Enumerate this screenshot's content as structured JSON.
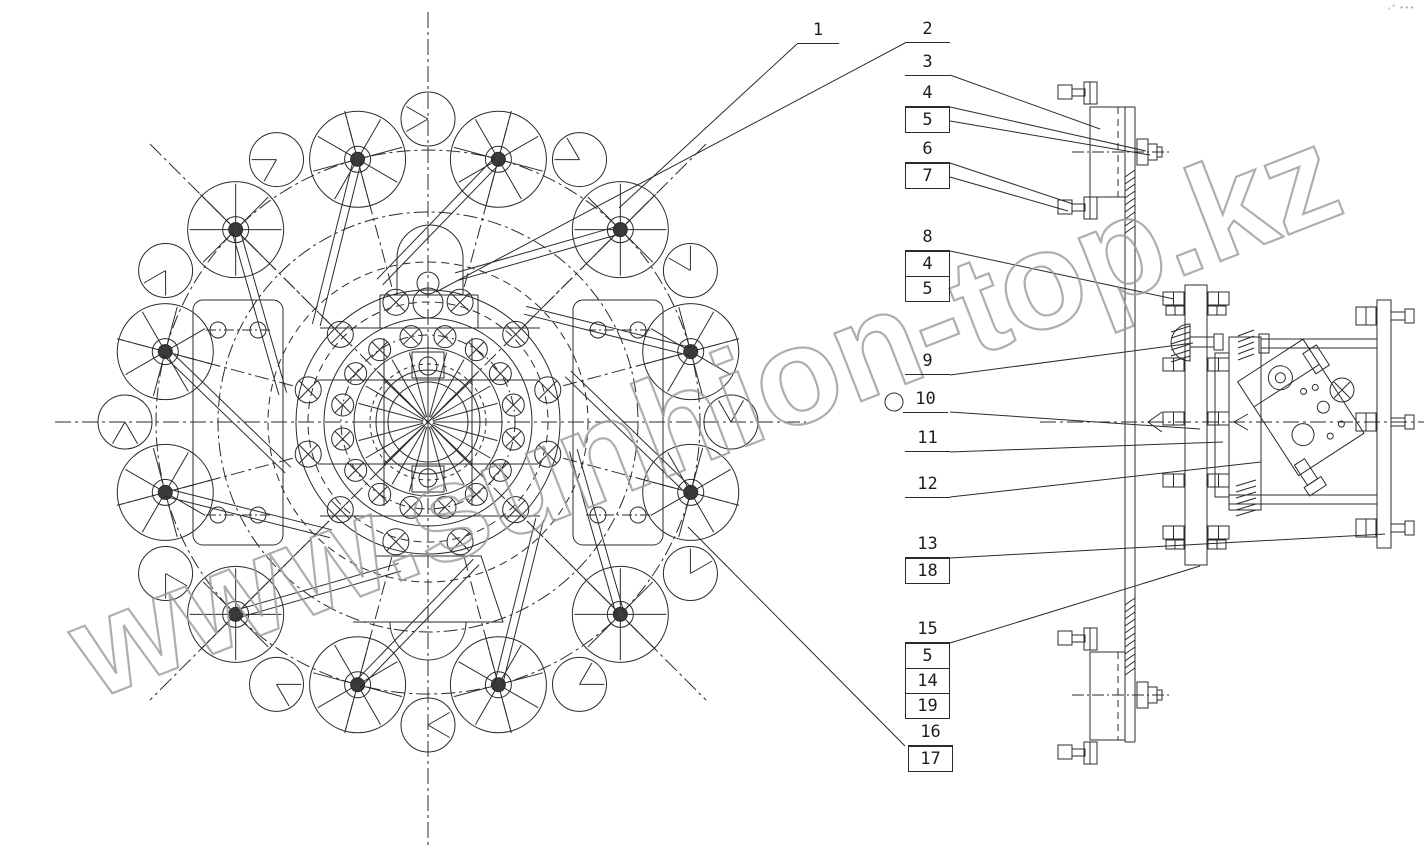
{
  "meta": {
    "background_color": "#ffffff",
    "line_color": "#2b2b2b",
    "corner_marks": "ₒ° •••"
  },
  "watermark": {
    "text": "www.sunhion-top.kz",
    "color": "#9b9b9b"
  },
  "callouts": [
    {
      "label": "1",
      "style": "underline"
    },
    {
      "label": "2",
      "style": "underline"
    },
    {
      "label": "3",
      "style": "underline"
    },
    {
      "label": "4",
      "style": "underline"
    },
    {
      "label": "5",
      "style": "box"
    },
    {
      "label": "6",
      "style": "underline"
    },
    {
      "label": "7",
      "style": "box"
    },
    {
      "label": "8",
      "style": "underline"
    },
    {
      "label": "4",
      "style": "box"
    },
    {
      "label": "5",
      "style": "box"
    },
    {
      "label": "9",
      "style": "underline"
    },
    {
      "label": "10",
      "style": "underline"
    },
    {
      "label": "11",
      "style": "underline"
    },
    {
      "label": "12",
      "style": "underline"
    },
    {
      "label": "13",
      "style": "underline"
    },
    {
      "label": "18",
      "style": "box"
    },
    {
      "label": "15",
      "style": "underline"
    },
    {
      "label": "5",
      "style": "box"
    },
    {
      "label": "14",
      "style": "box"
    },
    {
      "label": "19",
      "style": "box"
    },
    {
      "label": "16",
      "style": "underline"
    },
    {
      "label": "17",
      "style": "box"
    }
  ]
}
